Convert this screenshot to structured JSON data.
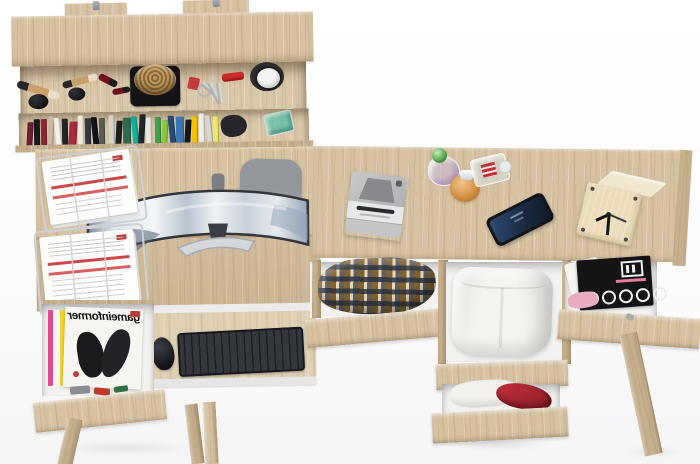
{
  "meta": {
    "type": "3d-product-render",
    "subject": "Light oak home-office desk set with wall shelf and open drawers, viewed from above",
    "background": "#fbfbfc"
  },
  "theme": {
    "wood": "#d7c2a2",
    "wood-light": "#e0d0b3",
    "wood-dark": "#c6af8c",
    "wood-edge": "#b89e78",
    "white-panel": "#f2f2f1",
    "accent-red": "#c23b3b",
    "metal": "#cfd2d4",
    "screen-blue": "#22406a",
    "keyboard-black": "#1e2023"
  },
  "wall_shelf": {
    "name": "wall-mounted shelf with two mounting brackets",
    "mounting_brackets": 2,
    "top_shelf_items": [
      {
        "name": "makeup brush",
        "color": "#caa06a"
      },
      {
        "name": "powder compact",
        "color": "#17171a"
      },
      {
        "name": "lipstick",
        "color": "#70121e"
      },
      {
        "name": "wicker basket on black tray",
        "color": "#a9895a"
      },
      {
        "name": "red keychain with keys",
        "color": "#c23b3b"
      },
      {
        "name": "swiss army knife",
        "color": "#cc2a2a"
      },
      {
        "name": "wrist watch",
        "color": "#f4f4f2"
      }
    ],
    "book_spine_colors": [
      "#6e1f2e",
      "#191a1e",
      "#8e2636",
      "#c9b9a2",
      "#f2efe8",
      "#23242a",
      "#a72c3c",
      "#efe9dd",
      "#343640",
      "#10131a",
      "#5a5e52",
      "#d8d3c8",
      "#1c1e24",
      "#2e6b4f",
      "#14b09a",
      "#20242b",
      "#e8e6df",
      "#3f9e4d",
      "#8cc63f",
      "#274a76",
      "#3b77b5",
      "#16181d",
      "#f5c400",
      "#f0eee8",
      "#d9d6cd",
      "#efe66a"
    ],
    "lower_shelf_extras": [
      {
        "name": "dark pouch",
        "color": "#26262b"
      },
      {
        "name": "teal glass bowl",
        "color": "#3ebead"
      }
    ]
  },
  "left_desk": {
    "paper_tray": {
      "type": "wire document trays",
      "trays": 2,
      "contents": "white documents with red heading bands",
      "accent_color": "#c23b3b"
    },
    "monitor": {
      "type": "curved ultrawide",
      "screen_content": "aerial view of snowy mountains",
      "frame_color": "#33363b"
    },
    "chair": {
      "color": "#93979b"
    },
    "keyboard": {
      "color": "#1e2023"
    },
    "mouse": {
      "color": "#121316"
    },
    "keyboard_tray": {
      "rail_color": "#ececec"
    },
    "drawer": {
      "state": "open",
      "magazine_title": "gameinformer",
      "title_mirrored": true,
      "cover_art": "black and white figures illustration",
      "spine_colors": [
        "#e04a8f",
        "#f6f5f1",
        "#f2d530",
        "#7bc24a"
      ]
    },
    "legs": 3
  },
  "right_desk": {
    "tabletop_items": [
      {
        "name": "instant camera",
        "color": "#c3c5c7"
      },
      {
        "name": "round perfume bottle with green cap",
        "cap_color": "#3f8f3c"
      },
      {
        "name": "round amber perfume bottle",
        "color": "#cf8a3e"
      },
      {
        "name": "rectangular clear perfume bottle",
        "accent_color": "#c4303a"
      },
      {
        "name": "smartphone",
        "screen_color": "#22406a"
      },
      {
        "name": "wooden cube clock",
        "hand_color": "#151515"
      }
    ],
    "drawers": [
      {
        "state": "open",
        "contents": "plaid shirt",
        "pattern_colors": [
          "#7d5824",
          "#2b3444",
          "#ece4d2"
        ]
      },
      {
        "state": "open",
        "contents": "folded white trousers",
        "color": "#f4f3ef"
      },
      {
        "state": "open",
        "contents": "music magazines with white circles and pink papers",
        "cover_color": "#141417"
      },
      {
        "state": "open",
        "contents": "white and red clothing",
        "accent_color": "#b22633"
      }
    ],
    "legs": 1
  }
}
